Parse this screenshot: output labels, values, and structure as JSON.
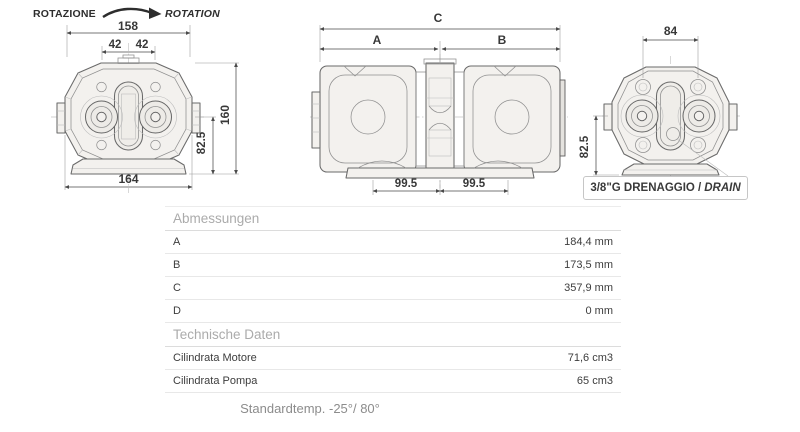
{
  "drawings": {
    "rotation_label_it": "ROTAZIONE",
    "rotation_label_en": "ROTATION",
    "front_view": {
      "dim_top_width": "158",
      "dim_bolt_left": "42",
      "dim_bolt_right": "42",
      "dim_total_height": "160",
      "dim_center_height": "82.5",
      "dim_bottom_width": "164"
    },
    "side_view": {
      "dim_total": "C",
      "dim_a": "A",
      "dim_b": "B",
      "dim_foot_left": "99.5",
      "dim_foot_right": "99.5"
    },
    "rear_view": {
      "dim_top_width": "84",
      "dim_center_height": "82.5",
      "drain_label_prefix": "3/8\"G DRENAGGIO /",
      "drain_label_italic": "DRAIN"
    }
  },
  "table": {
    "sections": [
      {
        "title": "Abmessungen",
        "rows": [
          [
            "A",
            "184,4 mm"
          ],
          [
            "B",
            "173,5 mm"
          ],
          [
            "C",
            "357,9 mm"
          ],
          [
            "D",
            "0 mm"
          ]
        ]
      },
      {
        "title": "Technische Daten",
        "rows": [
          [
            "Cilindrata Motore",
            "71,6 cm3"
          ],
          [
            "Cilindrata Pompa",
            "65 cm3"
          ]
        ]
      }
    ]
  },
  "footer": {
    "text": "Standardtemp. -25°/ 80°"
  }
}
